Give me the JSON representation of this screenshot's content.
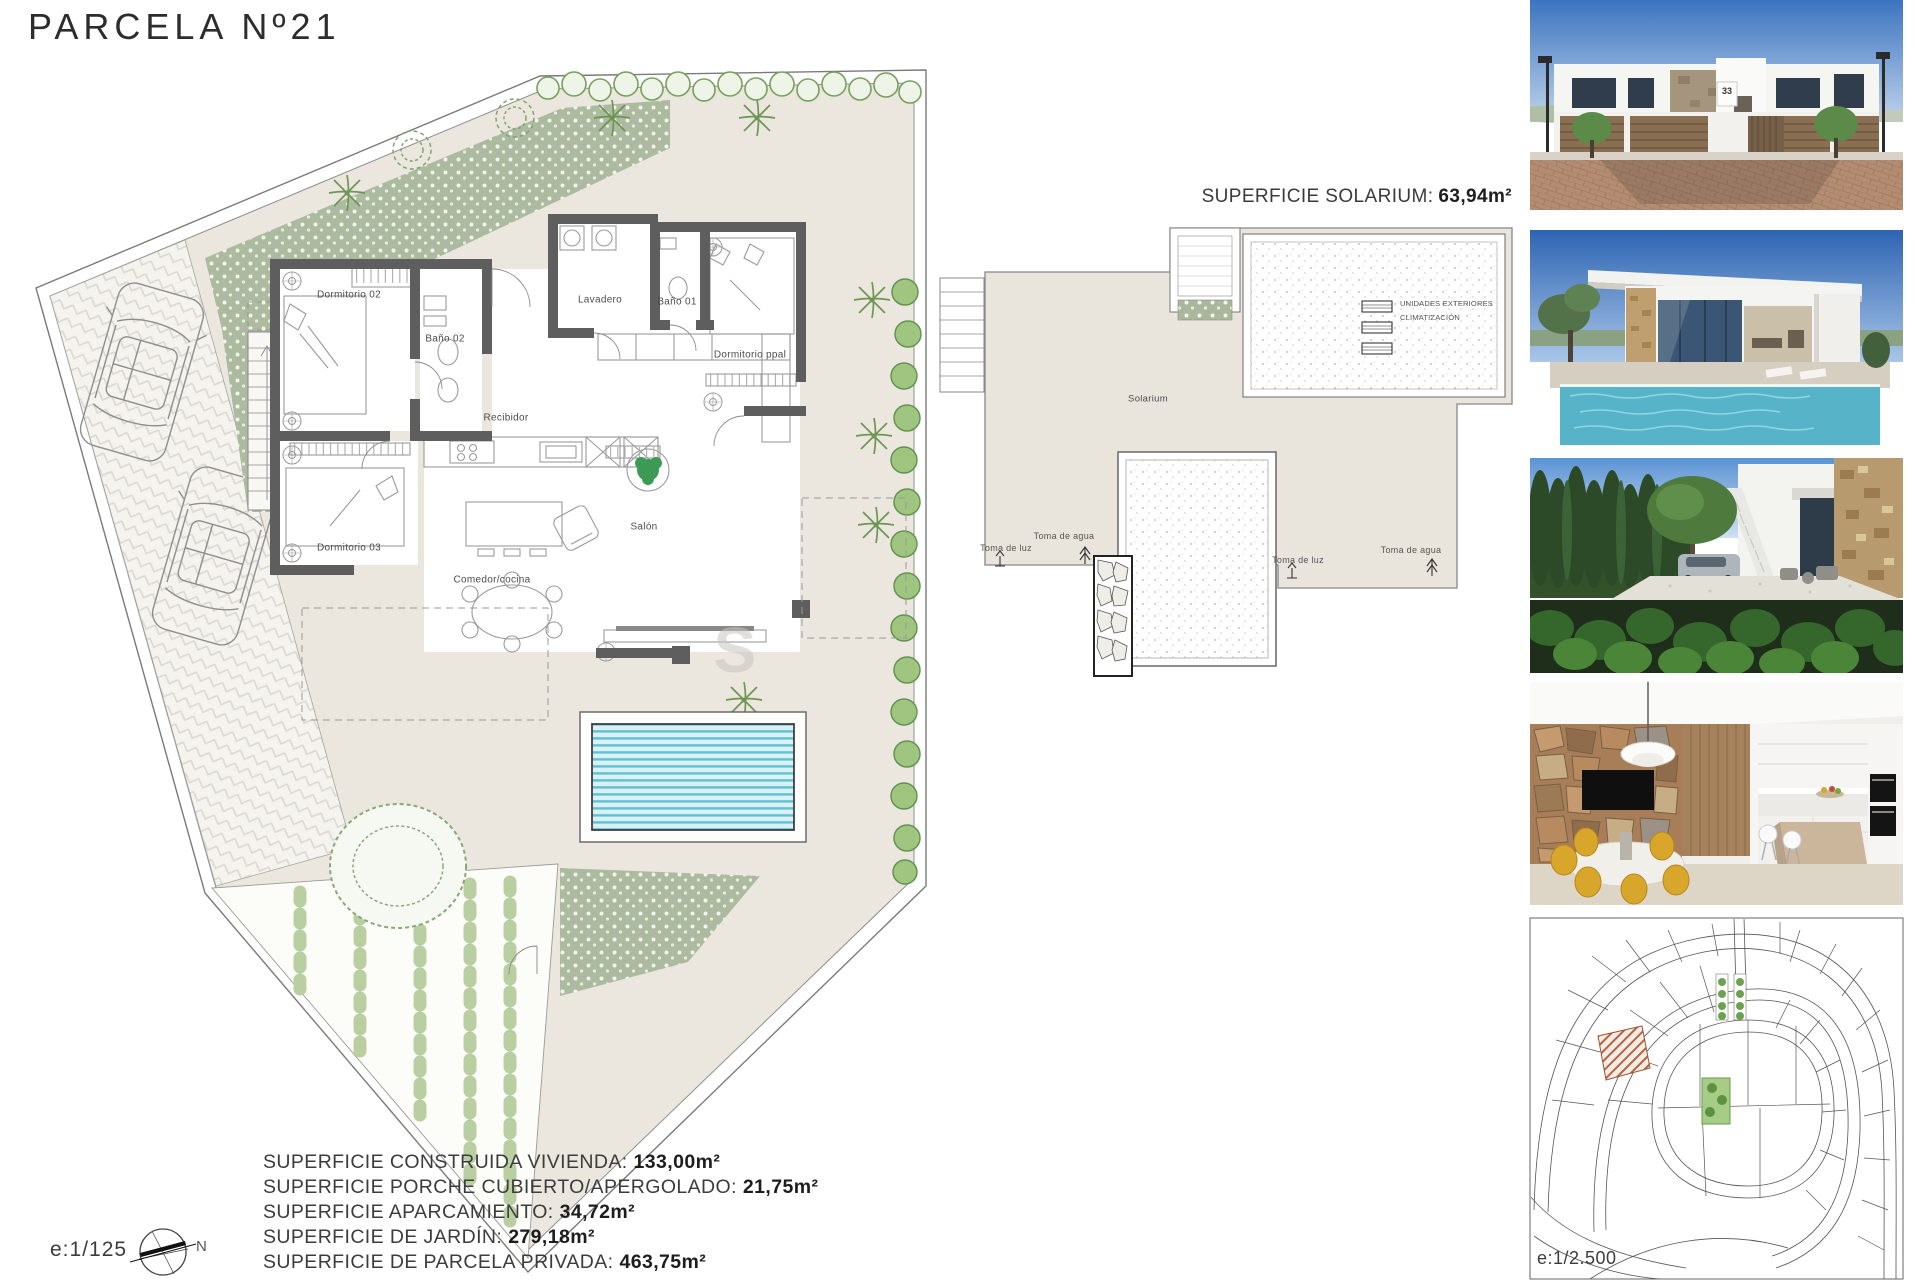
{
  "title": "PARCELA Nº21",
  "watermark": "S",
  "floor_plan": {
    "scale": "e:1/125",
    "north": "N",
    "rooms": {
      "dormitorio02": "Dormitorio 02",
      "bano02": "Baño 02",
      "lavadero": "Lavadero",
      "bano01": "Baño 01",
      "dormitorio_ppal": "Dormitorio ppal",
      "recibidor": "Recibidor",
      "dormitorio03": "Dormitorio 03",
      "comedor_cocina": "Comedor/cocina",
      "salon": "Salón"
    }
  },
  "solarium": {
    "heading_label": "SUPERFICIE SOLARIUM:",
    "heading_value": "63,94m²",
    "area": "Solarium",
    "ac_line1": "UNIDADES EXTERIORES",
    "ac_line2": "CLIMATIZACIÓN",
    "toma_luz_left": "Toma de luz",
    "toma_agua_left": "Toma de agua",
    "toma_luz_right": "Toma de luz",
    "toma_agua_right": "Toma de agua"
  },
  "surfaces": {
    "rows": [
      {
        "label": "SUPERFICIE CONSTRUIDA VIVIENDA:",
        "value": "133,00m²"
      },
      {
        "label": "SUPERFICIE PORCHE CUBIERTO/APERGOLADO:",
        "value": "21,75m²"
      },
      {
        "label": "SUPERFICIE APARCAMIENTO:",
        "value": "34,72m²"
      },
      {
        "label": "SUPERFICIE DE JARDÍN:",
        "value": "279,18m²"
      },
      {
        "label": "SUPERFICIE DE PARCELA PRIVADA:",
        "value": "463,75m²"
      }
    ]
  },
  "photos": {
    "street_view_house_number": "33"
  },
  "site_plan": {
    "scale": "e:1/2.500"
  },
  "colors": {
    "wall": "#5e5e5e",
    "terrace_beige": "#ece7de",
    "gravel_green": "#a9b89d",
    "pool_blue": "#5fc0d2",
    "hedge_green": "#6f9c54"
  }
}
